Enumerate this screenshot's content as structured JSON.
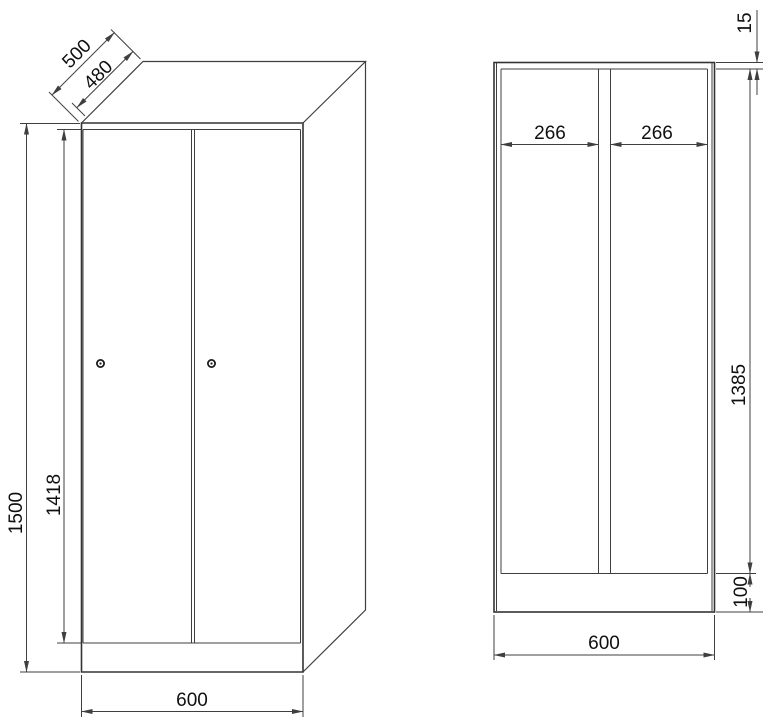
{
  "drawing": {
    "subject": "two-door locker cabinet dimensional drawing",
    "line_color": "#3f3f3f",
    "text_color": "#101010",
    "background": "#ffffff",
    "lock_count_left_view": 2
  },
  "dims": {
    "left_view": {
      "depth_total": "500",
      "depth_body": "480",
      "height_total": "1500",
      "door_height": "1418",
      "width_total": "600"
    },
    "right_view": {
      "top_panel_thickness": "15",
      "left_compartment_width": "266",
      "right_compartment_width": "266",
      "interior_height": "1385",
      "plinth_height": "100",
      "width_total": "600"
    }
  }
}
